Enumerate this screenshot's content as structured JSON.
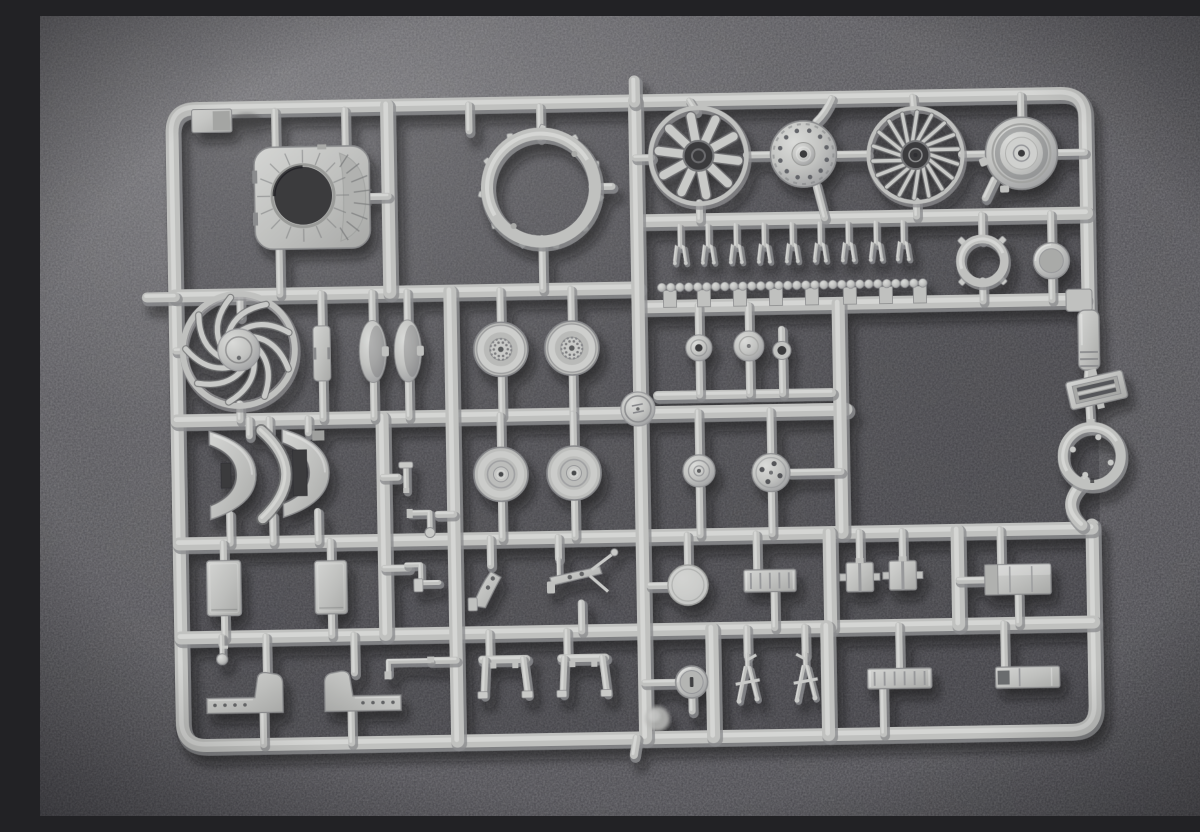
{
  "scene": {
    "description": "Photograph of a light-grey injection-molded model-kit sprue (parts tree) with aircraft engine fans, wheels and small brackets, lying on a dark grey carpet-textured background",
    "palette": {
      "bg_base": "#58575a",
      "bg_light": "#6c6b6e",
      "bg_dark": "#3c3b3f",
      "plastic_base": "#c0c1bf",
      "plastic_mid": "#c9cac8",
      "plastic_light": "#d8d9d7",
      "plastic_edge": "#8b8c8e",
      "plastic_deep": "#6e6f71",
      "hole_dark": "#3b3a3e"
    },
    "frame": {
      "left": 137,
      "top": 85,
      "right": 1050,
      "bottom": 722,
      "width": 13,
      "corner": 24,
      "right_gap_top": 303,
      "right_gap_bottom": 517,
      "tilt_deg": -1
    },
    "runners": [
      [
        137,
        272,
        600,
        272
      ],
      [
        600,
        205,
        1050,
        205
      ],
      [
        600,
        291,
        1046,
        291
      ],
      [
        137,
        397,
        806,
        397
      ],
      [
        137,
        520,
        1050,
        520
      ],
      [
        137,
        614,
        1050,
        614
      ],
      [
        352,
        85,
        352,
        272
      ],
      [
        600,
        85,
        600,
        722
      ],
      [
        412,
        272,
        412,
        722
      ],
      [
        342,
        397,
        342,
        614
      ],
      [
        800,
        291,
        800,
        520
      ],
      [
        787,
        520,
        787,
        614
      ],
      [
        783,
        614,
        783,
        722
      ],
      [
        915,
        520,
        915,
        614
      ],
      [
        668,
        614,
        668,
        722
      ],
      [
        618,
        380,
        792,
        380,
        9
      ]
    ],
    "stems": [
      [
        600,
        65,
        600,
        86,
        11
      ],
      [
        109,
        273,
        137,
        273,
        10
      ],
      [
        591,
        722,
        588,
        739,
        8
      ],
      [
        240,
        89,
        240,
        126
      ],
      [
        310,
        89,
        310,
        126
      ],
      [
        242,
        226,
        242,
        272
      ],
      [
        333,
        176,
        352,
        176
      ],
      [
        434,
        86,
        434,
        112
      ],
      [
        505,
        89,
        505,
        120
      ],
      [
        505,
        221,
        505,
        272
      ],
      [
        556,
        170,
        576,
        170
      ],
      [
        600,
        142,
        616,
        142
      ],
      [
        711,
        141,
        736,
        141
      ],
      [
        655,
        86,
        661,
        96
      ],
      [
        663,
        188,
        663,
        205
      ],
      [
        801,
        142,
        832,
        142
      ],
      [
        780,
        172,
        788,
        205
      ],
      [
        878,
        86,
        879,
        98
      ],
      [
        926,
        144,
        950,
        144
      ],
      [
        880,
        190,
        880,
        205
      ],
      [
        986,
        86,
        986,
        110
      ],
      [
        1021,
        144,
        1049,
        144
      ],
      [
        958,
        170,
        949,
        188
      ],
      [
        202,
        272,
        202,
        294
      ],
      [
        137,
        327,
        147,
        327
      ],
      [
        200,
        381,
        200,
        397
      ],
      [
        283,
        272,
        283,
        306
      ],
      [
        283,
        358,
        283,
        397
      ],
      [
        334,
        272,
        334,
        302
      ],
      [
        334,
        359,
        334,
        397
      ],
      [
        369,
        272,
        369,
        302
      ],
      [
        369,
        359,
        369,
        397
      ],
      [
        462,
        272,
        462,
        305
      ],
      [
        462,
        357,
        462,
        397
      ],
      [
        533,
        272,
        533,
        305
      ],
      [
        533,
        357,
        533,
        397
      ],
      [
        660,
        291,
        660,
        321
      ],
      [
        660,
        345,
        660,
        380
      ],
      [
        710,
        291,
        710,
        318
      ],
      [
        710,
        346,
        710,
        380
      ],
      [
        743,
        316,
        743,
        329
      ],
      [
        743,
        345,
        743,
        380
      ],
      [
        209,
        397,
        209,
        413
      ],
      [
        188,
        491,
        188,
        520
      ],
      [
        229,
        397,
        229,
        410
      ],
      [
        231,
        493,
        231,
        520
      ],
      [
        268,
        397,
        268,
        411
      ],
      [
        276,
        490,
        276,
        520
      ],
      [
        460,
        397,
        460,
        430
      ],
      [
        460,
        482,
        460,
        520
      ],
      [
        533,
        397,
        533,
        430
      ],
      [
        533,
        482,
        533,
        520
      ],
      [
        342,
        457,
        357,
        457
      ],
      [
        412,
        495,
        396,
        495
      ],
      [
        342,
        548,
        366,
        548
      ],
      [
        658,
        397,
        658,
        441
      ],
      [
        658,
        471,
        658,
        520
      ],
      [
        730,
        397,
        730,
        441
      ],
      [
        749,
        459,
        800,
        459
      ],
      [
        730,
        477,
        730,
        520
      ],
      [
        645,
        520,
        645,
        551
      ],
      [
        607,
        570,
        626,
        570
      ],
      [
        181,
        520,
        181,
        539
      ],
      [
        181,
        591,
        181,
        614
      ],
      [
        288,
        520,
        288,
        541
      ],
      [
        288,
        591,
        288,
        614
      ],
      [
        448,
        520,
        448,
        547
      ],
      [
        516,
        520,
        516,
        541
      ],
      [
        538,
        586,
        538,
        614
      ],
      [
        714,
        520,
        714,
        557
      ],
      [
        731,
        577,
        731,
        614
      ],
      [
        817,
        520,
        817,
        552
      ],
      [
        860,
        520,
        860,
        551
      ],
      [
        941,
        570,
        916,
        570
      ],
      [
        958,
        520,
        958,
        556
      ],
      [
        975,
        585,
        975,
        614
      ],
      [
        222,
        614,
        222,
        652
      ],
      [
        218,
        689,
        218,
        722
      ],
      [
        310,
        614,
        310,
        652
      ],
      [
        306,
        689,
        306,
        722
      ],
      [
        178,
        614,
        178,
        621
      ],
      [
        386,
        641,
        412,
        641
      ],
      [
        445,
        614,
        445,
        638
      ],
      [
        523,
        614,
        523,
        638
      ],
      [
        600,
        667,
        632,
        667
      ],
      [
        647,
        682,
        647,
        696
      ],
      [
        703,
        614,
        703,
        642
      ],
      [
        761,
        614,
        761,
        642
      ],
      [
        855,
        614,
        855,
        658
      ],
      [
        838,
        676,
        838,
        722
      ],
      [
        960,
        614,
        960,
        659
      ],
      [
        945,
        205,
        945,
        230
      ],
      [
        945,
        271,
        945,
        291
      ],
      [
        1014,
        205,
        1014,
        235
      ],
      [
        1014,
        269,
        1014,
        291
      ],
      [
        1049,
        360,
        1048,
        370
      ],
      [
        1049,
        395,
        1050,
        420
      ]
    ],
    "curves": [
      {
        "d": "M1043,473 C1026,488 1024,502 1040,517",
        "w": 11
      },
      {
        "d": "M797,86 Q791,100 781,109",
        "w": 7
      }
    ],
    "blocks": [
      [
        1028,
        281,
        26,
        22
      ]
    ],
    "pin_row": {
      "xs": [
        643,
        671,
        699,
        727,
        755,
        783,
        811,
        839,
        866
      ],
      "y_top": 211
    },
    "bead_strip": {
      "x1": 624,
      "x2": 886,
      "y": 272,
      "r": 4.3,
      "step": 9,
      "stubs": [
        632,
        666,
        702,
        738,
        774,
        812,
        848,
        882
      ]
    },
    "parts": [
      {
        "id": "corner-tag",
        "type": "cornerTag",
        "x": 176,
        "y": 97
      },
      {
        "id": "engine-mount-plate",
        "type": "enginePlate",
        "x": 276,
        "y": 176,
        "w": 115,
        "h": 102
      },
      {
        "id": "cowl-ring",
        "type": "toothedRing",
        "x": 505,
        "y": 170,
        "r": 54
      },
      {
        "id": "radial-engine-fan",
        "type": "radialFan",
        "x": 663,
        "y": 141,
        "r": 48
      },
      {
        "id": "engine-hub-disc",
        "type": "hubDisc",
        "x": 768,
        "y": 141,
        "r": 33
      },
      {
        "id": "turbine-fan",
        "type": "turbineFan",
        "x": 880,
        "y": 144,
        "r": 47
      },
      {
        "id": "hub-cover-disc",
        "type": "ringsDisc",
        "x": 986,
        "y": 144,
        "r": 36
      },
      {
        "id": "tab-ring",
        "type": "tabRing",
        "x": 945,
        "y": 251,
        "r": 22
      },
      {
        "id": "cup-disc",
        "type": "cupDisc",
        "x": 1014,
        "y": 252,
        "r": 18
      },
      {
        "id": "impeller-fan",
        "type": "swirlFan",
        "x": 200,
        "y": 327,
        "r": 56
      },
      {
        "id": "link-stick",
        "type": "stick",
        "x": 283,
        "y": 332
      },
      {
        "id": "dome-half-a",
        "type": "domeHalf",
        "x": 334,
        "y": 331
      },
      {
        "id": "dome-half-b",
        "type": "domeHalf",
        "x": 369,
        "y": 331
      },
      {
        "id": "wheel-spoked-a",
        "type": "wheelSpoked",
        "x": 462,
        "y": 331,
        "r": 27
      },
      {
        "id": "wheel-spoked-b",
        "type": "wheelSpoked",
        "x": 533,
        "y": 331,
        "r": 27
      },
      {
        "id": "gate-medallion",
        "type": "medallion",
        "x": 598,
        "y": 393,
        "r": 17
      },
      {
        "id": "small-disc-a",
        "type": "smallDiscHole",
        "x": 660,
        "y": 333,
        "r": 13
      },
      {
        "id": "small-disc-b",
        "type": "smallDisc",
        "x": 710,
        "y": 332,
        "r": 15
      },
      {
        "id": "grommet-ring",
        "type": "grommet",
        "x": 743,
        "y": 337,
        "r": 9
      },
      {
        "id": "intake-lip-a",
        "type": "saddle",
        "x": 193,
        "y": 452,
        "variant": 1
      },
      {
        "id": "lip-strip",
        "type": "crescentStrip",
        "x": 229,
        "y": 452
      },
      {
        "id": "intake-lip-b",
        "type": "saddle",
        "x": 266,
        "y": 451,
        "variant": 2
      },
      {
        "id": "pipe-tee",
        "type": "tinyT",
        "x": 365,
        "y": 457
      },
      {
        "id": "pipe-elbow",
        "type": "lPipe",
        "x": 382,
        "y": 495
      },
      {
        "id": "pipe-zbend",
        "type": "sPipe",
        "x": 380,
        "y": 553
      },
      {
        "id": "wheel-plain-a",
        "type": "wheelPlain",
        "x": 460,
        "y": 456,
        "r": 27
      },
      {
        "id": "wheel-plain-b",
        "type": "wheelPlain",
        "x": 533,
        "y": 456,
        "r": 27
      },
      {
        "id": "hub-rings-disc",
        "type": "smallDiscRings",
        "x": 658,
        "y": 456,
        "r": 16
      },
      {
        "id": "brake-disc",
        "type": "holedDisc",
        "x": 730,
        "y": 459,
        "r": 19
      },
      {
        "id": "panel-a",
        "type": "panel",
        "x": 181,
        "y": 565,
        "w": 34,
        "h": 55
      },
      {
        "id": "panel-b",
        "type": "panel",
        "x": 288,
        "y": 566,
        "w": 32,
        "h": 53
      },
      {
        "id": "gear-arm-a",
        "type": "gearLeg",
        "x": 446,
        "y": 567
      },
      {
        "id": "gear-arm-b",
        "type": "gearLeg2",
        "x": 535,
        "y": 558
      },
      {
        "id": "face-disc",
        "type": "faceDisc",
        "x": 645,
        "y": 570,
        "r": 20
      },
      {
        "id": "ribbed-box-a",
        "type": "ribbedBox",
        "x": 727,
        "y": 567,
        "w": 52,
        "h": 22,
        "ribs": 5
      },
      {
        "id": "clamp-a",
        "type": "clampSquare",
        "x": 817,
        "y": 565
      },
      {
        "id": "clamp-b",
        "type": "clampSquare",
        "x": 860,
        "y": 564
      },
      {
        "id": "end-box-a",
        "type": "endBox",
        "x": 975,
        "y": 570
      },
      {
        "id": "ball-pin",
        "type": "ballPin",
        "x": 178,
        "y": 626
      },
      {
        "id": "rod-elbow",
        "type": "rodElbow",
        "x": 364,
        "y": 644
      },
      {
        "id": "boot-bracket-a",
        "type": "bootBracket",
        "x": 200,
        "y": 671,
        "flip": false
      },
      {
        "id": "boot-bracket-b",
        "type": "bootBracket",
        "x": 318,
        "y": 671,
        "flip": true
      },
      {
        "id": "u-bracket-a",
        "type": "uBracket",
        "x": 460,
        "y": 650
      },
      {
        "id": "u-bracket-b",
        "type": "uBracket",
        "x": 539,
        "y": 650
      },
      {
        "id": "slot-disc",
        "type": "slotDisc",
        "x": 647,
        "y": 667,
        "r": 16
      },
      {
        "id": "fork-a",
        "type": "forkPart",
        "x": 703,
        "y": 664,
        "flip": false
      },
      {
        "id": "fork-b",
        "type": "forkPart",
        "x": 761,
        "y": 664,
        "flip": true
      },
      {
        "id": "ribbed-box-b",
        "type": "ribbedBox",
        "x": 855,
        "y": 667,
        "w": 64,
        "h": 20,
        "ribs": 6
      },
      {
        "id": "end-box-b",
        "type": "endBox2",
        "x": 983,
        "y": 668
      },
      {
        "id": "feed-rod",
        "type": "feedRod",
        "x": 1050,
        "y": 332
      },
      {
        "id": "grille-plate",
        "type": "grille",
        "x": 1057,
        "y": 382,
        "rot": -12
      },
      {
        "id": "collar-ring",
        "type": "innerTabRing",
        "x": 1051,
        "y": 448,
        "r": 29
      },
      {
        "id": "gate-blob",
        "type": "blob",
        "x": 612,
        "y": 703,
        "r": 12
      }
    ]
  }
}
